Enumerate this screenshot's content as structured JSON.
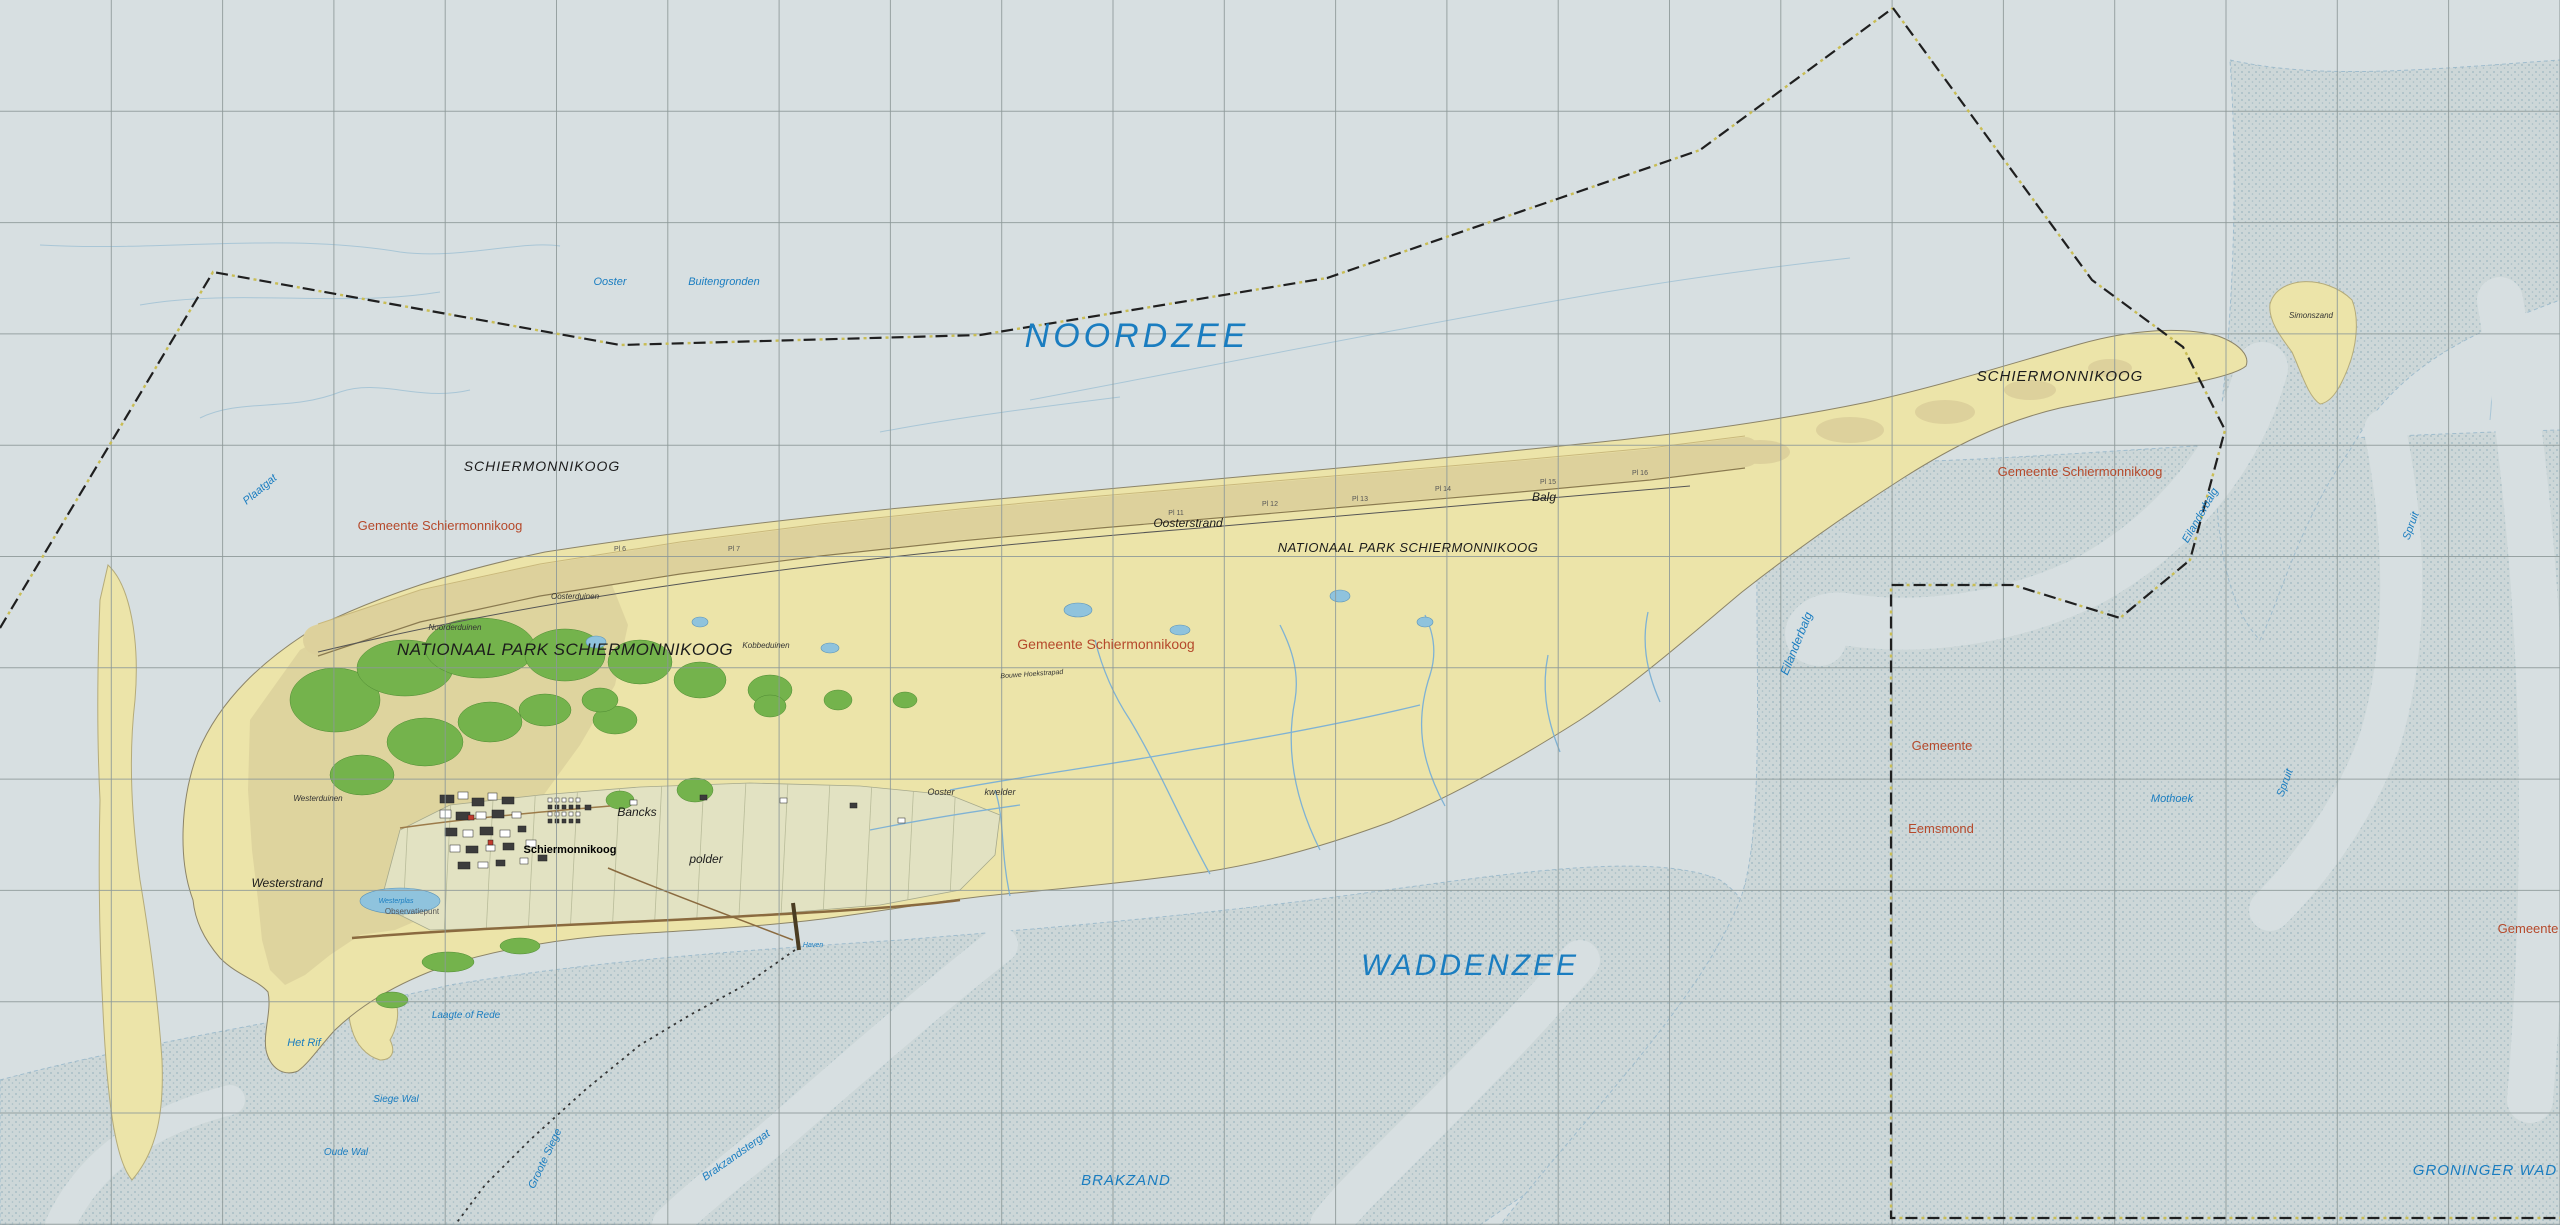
{
  "map": {
    "kind": "topographic-map",
    "labels": [
      {
        "t": "NOORDZEE",
        "x": 1137,
        "y": 347,
        "c": "lw",
        "s": 34,
        "ls": 4
      },
      {
        "t": "WADDENZEE",
        "x": 1470,
        "y": 975,
        "c": "lw",
        "s": 30,
        "ls": 3
      },
      {
        "t": "BRAKZAND",
        "x": 1126,
        "y": 1185,
        "c": "lw",
        "s": 15,
        "ls": 1
      },
      {
        "t": "GRONINGER WAD",
        "x": 2485,
        "y": 1175,
        "c": "lw",
        "s": 15,
        "ls": 1
      },
      {
        "t": "Ooster",
        "x": 610,
        "y": 285,
        "c": "lw",
        "s": 11
      },
      {
        "t": "Buitengronden",
        "x": 724,
        "y": 285,
        "c": "lw",
        "s": 11
      },
      {
        "t": "Plaatgat",
        "x": 262,
        "y": 492,
        "c": "lw",
        "s": 11,
        "r": -40
      },
      {
        "t": "Laagte of Rede",
        "x": 466,
        "y": 1018,
        "c": "lw",
        "s": 10
      },
      {
        "t": "Siege Wal",
        "x": 396,
        "y": 1102,
        "c": "lw",
        "s": 10
      },
      {
        "t": "Oude Wal",
        "x": 346,
        "y": 1155,
        "c": "lw",
        "s": 10
      },
      {
        "t": "Groote Siege",
        "x": 548,
        "y": 1160,
        "c": "lw",
        "s": 11,
        "r": -65
      },
      {
        "t": "Brakzandstergat",
        "x": 738,
        "y": 1158,
        "c": "lw",
        "s": 11,
        "r": -35
      },
      {
        "t": "Mothoek",
        "x": 2172,
        "y": 802,
        "c": "lw",
        "s": 11
      },
      {
        "t": "Spruit",
        "x": 2288,
        "y": 784,
        "c": "lw",
        "s": 11,
        "r": -70
      },
      {
        "t": "Spruit",
        "x": 2414,
        "y": 527,
        "c": "lw",
        "s": 11,
        "r": -70
      },
      {
        "t": "Eilanderbalg",
        "x": 1800,
        "y": 645,
        "c": "lw",
        "s": 12,
        "r": -68
      },
      {
        "t": "Eilanderbalg",
        "x": 2203,
        "y": 517,
        "c": "lw",
        "s": 11,
        "r": -60
      },
      {
        "t": "Haven",
        "x": 813,
        "y": 947,
        "c": "lw",
        "s": 7
      },
      {
        "t": "Westerplas",
        "x": 396,
        "y": 903,
        "c": "lw",
        "s": 7
      },
      {
        "t": "Het Rif",
        "x": 304,
        "y": 1046,
        "c": "lw",
        "s": 11
      },
      {
        "t": "SCHIERMONNIKOOG",
        "x": 542,
        "y": 471,
        "c": "lt",
        "s": 14,
        "ls": 1
      },
      {
        "t": "SCHIERMONNIKOOG",
        "x": 2060,
        "y": 381,
        "c": "lt",
        "s": 15,
        "ls": 1
      },
      {
        "t": "NATIONAAL PARK SCHIERMONNIKOOG",
        "x": 565,
        "y": 655,
        "c": "lt",
        "s": 17,
        "ls": 0.5
      },
      {
        "t": "NATIONAAL PARK SCHIERMONNIKOOG",
        "x": 1408,
        "y": 552,
        "c": "lt",
        "s": 13,
        "ls": 0.5
      },
      {
        "t": "Oosterstrand",
        "x": 1188,
        "y": 527,
        "c": "lt",
        "s": 12
      },
      {
        "t": "Westerstrand",
        "x": 287,
        "y": 887,
        "c": "lt",
        "s": 12
      },
      {
        "t": "Balg",
        "x": 1544,
        "y": 501,
        "c": "lt",
        "s": 12
      },
      {
        "t": "Oosterduinen",
        "x": 575,
        "y": 599,
        "c": "lt-xs",
        "s": 8
      },
      {
        "t": "Noorderduinen",
        "x": 455,
        "y": 630,
        "c": "lt-xs",
        "s": 8
      },
      {
        "t": "Westerduinen",
        "x": 318,
        "y": 801,
        "c": "lt-xs",
        "s": 8
      },
      {
        "t": "Kobbeduinen",
        "x": 766,
        "y": 648,
        "c": "lt-xs",
        "s": 8
      },
      {
        "t": "Ooster",
        "x": 941,
        "y": 795,
        "c": "lt-xs",
        "s": 9
      },
      {
        "t": "kwelder",
        "x": 1000,
        "y": 795,
        "c": "lt-xs",
        "s": 9
      },
      {
        "t": "Simonszand",
        "x": 2311,
        "y": 318,
        "c": "lt-xs",
        "s": 8
      },
      {
        "t": "Bancks",
        "x": 637,
        "y": 816,
        "c": "lt",
        "s": 12
      },
      {
        "t": "polder",
        "x": 706,
        "y": 863,
        "c": "lt",
        "s": 12
      },
      {
        "t": "Schiermonnikoog",
        "x": 570,
        "y": 853,
        "c": "vil",
        "s": 11
      },
      {
        "t": "Gemeente Schiermonnikoog",
        "x": 440,
        "y": 530,
        "c": "muni",
        "s": 13
      },
      {
        "t": "Gemeente Schiermonnikoog",
        "x": 1106,
        "y": 649,
        "c": "muni",
        "s": 14
      },
      {
        "t": "Gemeente Schiermonnikoog",
        "x": 2080,
        "y": 476,
        "c": "muni",
        "s": 13
      },
      {
        "t": "Gemeente",
        "x": 1942,
        "y": 750,
        "c": "muni",
        "s": 13
      },
      {
        "t": "Eemsmond",
        "x": 1941,
        "y": 833,
        "c": "muni",
        "s": 13
      },
      {
        "t": "Gemeente",
        "x": 2528,
        "y": 933,
        "c": "muni",
        "s": 13
      },
      {
        "t": "Observatiepunt",
        "x": 412,
        "y": 914,
        "c": "pole",
        "s": 8
      },
      {
        "t": "Bouwe Hoekstrapad",
        "x": 1032,
        "y": 676,
        "c": "lt-xs",
        "s": 7,
        "r": -4
      },
      {
        "t": "Pl 6",
        "x": 620,
        "y": 551,
        "c": "pole",
        "s": 7
      },
      {
        "t": "Pl 7",
        "x": 734,
        "y": 551,
        "c": "pole",
        "s": 7
      },
      {
        "t": "Pl 11",
        "x": 1176,
        "y": 515,
        "c": "pole",
        "s": 7
      },
      {
        "t": "Pl 12",
        "x": 1270,
        "y": 506,
        "c": "pole",
        "s": 7
      },
      {
        "t": "Pl 13",
        "x": 1360,
        "y": 501,
        "c": "pole",
        "s": 7
      },
      {
        "t": "Pl 14",
        "x": 1443,
        "y": 491,
        "c": "pole",
        "s": 7
      },
      {
        "t": "Pl 15",
        "x": 1548,
        "y": 484,
        "c": "pole",
        "s": 7
      },
      {
        "t": "Pl 16",
        "x": 1640,
        "y": 475,
        "c": "pole",
        "s": 7
      }
    ],
    "colors": {
      "sea": "#d7dfe1",
      "tidal_flat": "#cdd7d8",
      "tidal_flat_dots": "#9db7bf",
      "sand": "#ece4a9",
      "dune": "#ddd19c",
      "forest": "#74b34c",
      "polder": "#e2e2c2",
      "lake": "#8fc3dd",
      "creek": "#7fb2d4",
      "contour": "#a9c6d6",
      "road": "#8a6a3f",
      "grid": "#8c9898",
      "boundary": "#1f1f1f",
      "boundary_accent": "#c9bd54",
      "water_label": "#1a7dc0",
      "terrain_label": "#1c1c1c",
      "municipal_label": "#b5492b",
      "building": "#3c3c3c"
    }
  }
}
